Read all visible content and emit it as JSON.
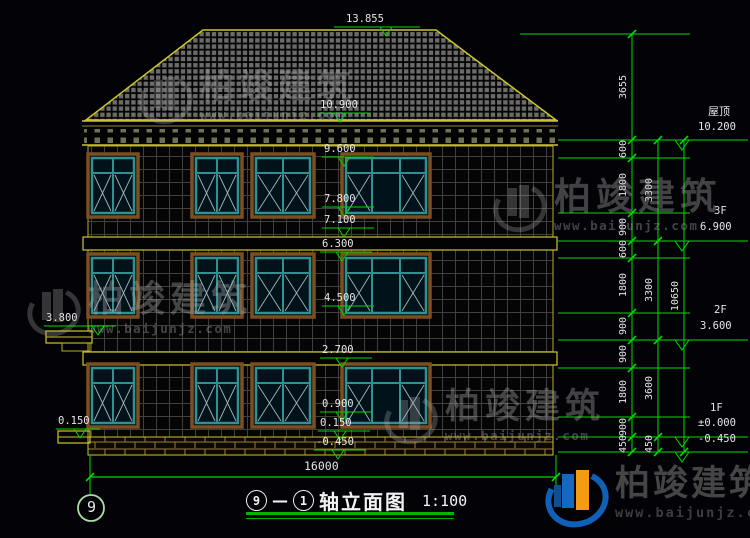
{
  "drawing": {
    "title_axis_start": "9",
    "title_dash": "—",
    "title_axis_end": "1",
    "title_name": "轴立面图",
    "title_scale": "1:100",
    "axis_bubble": "9",
    "total_width_dim": "16000"
  },
  "levels": {
    "roof_label": "屋顶",
    "roof_value": "10.200",
    "f3_label": "3F",
    "f3_value": "6.900",
    "f2_label": "2F",
    "f2_value": "3.600",
    "f1_label": "1F",
    "f1_value": "±0.000",
    "ground_value": "-0.450"
  },
  "center_marks": [
    "13.855",
    "10.900",
    "9.600",
    "7.800",
    "7.100",
    "6.300",
    "4.500",
    "2.700",
    "0.900",
    "0.150",
    "-0.450"
  ],
  "left_marks": [
    "3.800",
    "0.150"
  ],
  "dims": {
    "inner": [
      "3655",
      "600",
      "1800",
      "900",
      "600",
      "1800",
      "900",
      "900",
      "1800",
      "900",
      "450"
    ],
    "middle": [
      "3300",
      "3300",
      "3600",
      "450"
    ],
    "outer": [
      "10650"
    ]
  },
  "brand": {
    "name": "柏竣建筑",
    "website": "www.baijunjz.com"
  },
  "colors": {
    "dim_green": "#00d800",
    "line_yellow": "#cdc52c",
    "frame_teal": "#2f9292",
    "frame_brown": "#7c4f22",
    "logo_blue": "#1468c0",
    "logo_orange": "#f39c12"
  }
}
